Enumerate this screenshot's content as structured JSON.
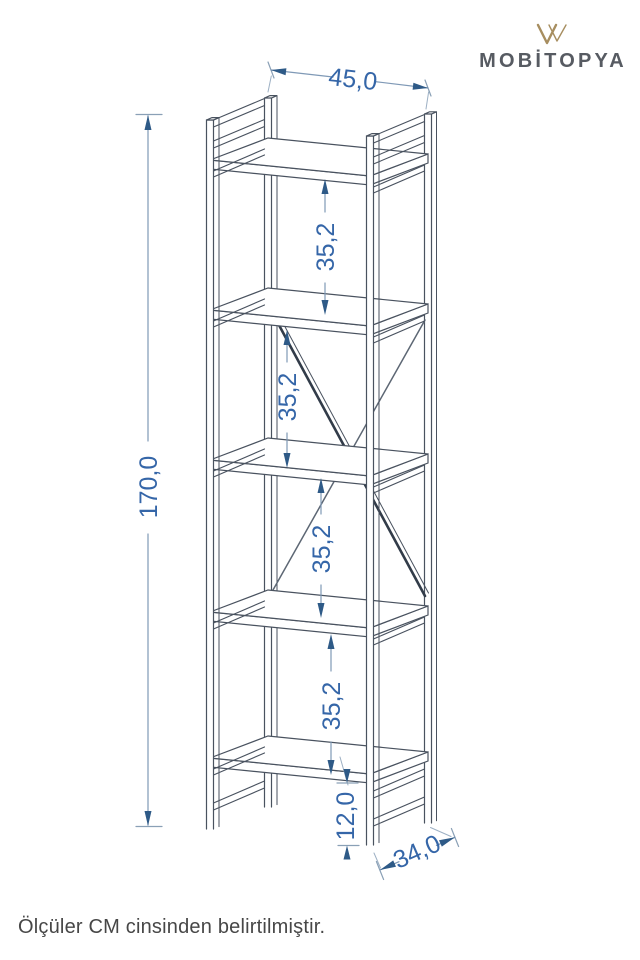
{
  "brand": {
    "name": "MOBİTOPYA",
    "monogram": "double-v-monogram"
  },
  "note": "Ölçüler CM cinsinden belirtilmiştir.",
  "dims": {
    "width": "45,0",
    "height": "170,0",
    "depth": "34,0",
    "bottom": "12,0",
    "bays": [
      "35,2",
      "35,2",
      "35,2",
      "35,2"
    ]
  },
  "units": "CM",
  "colors": {
    "dimension_text": "#3566a8",
    "dimension_line": "#7f99b6",
    "dimension_arrow": "#2e5a87",
    "structure_line": "#49525f",
    "brace_dark": "#323c49",
    "brand_gold": "#a78e60",
    "brand_text": "#575b62",
    "note_text": "#474747",
    "background": "#ffffff"
  }
}
